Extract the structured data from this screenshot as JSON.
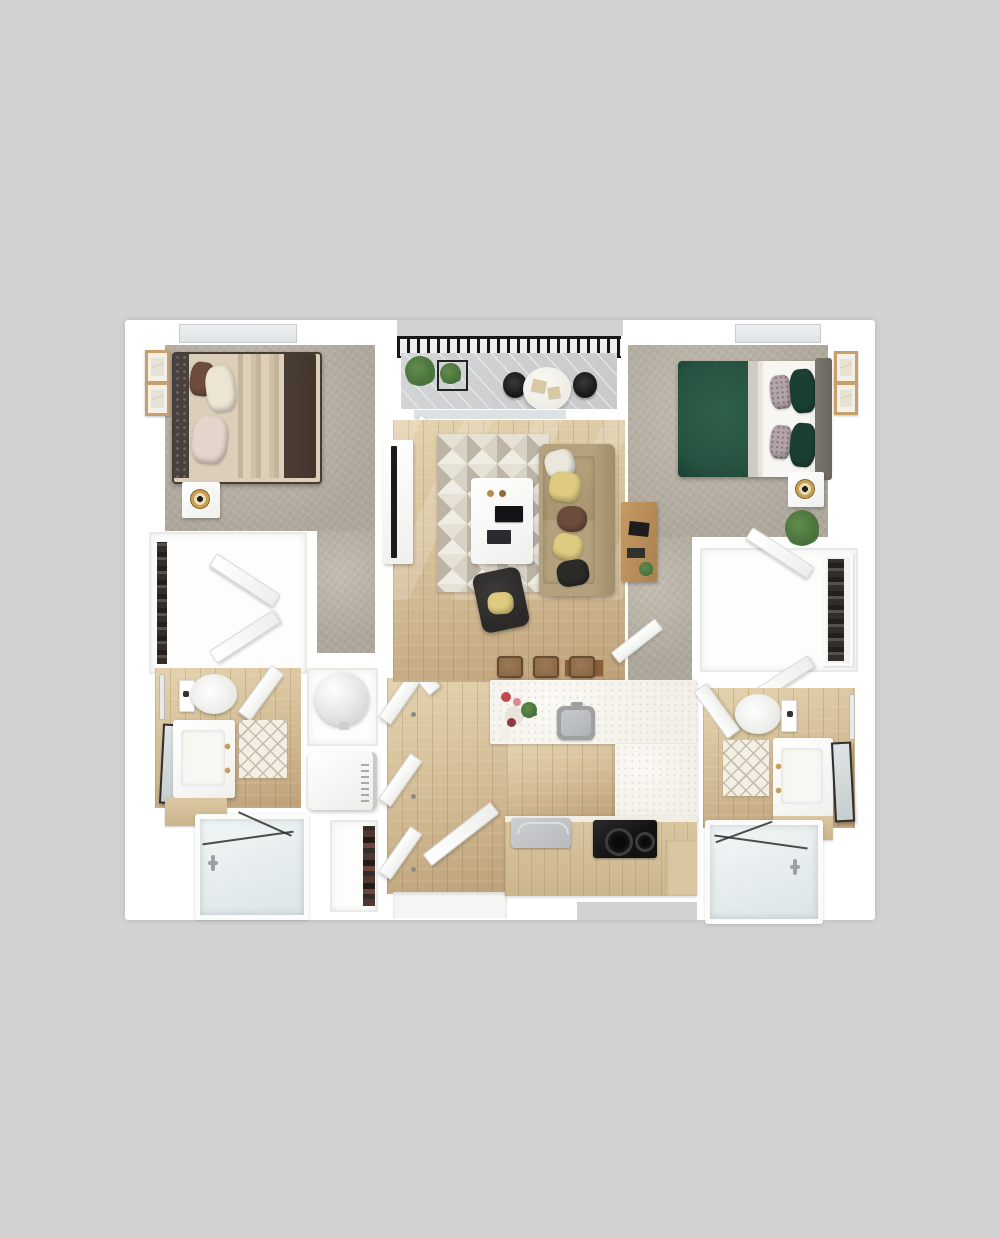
{
  "scene": {
    "label": "Top-down 3D rendered floor plan of a two-bedroom, two-bathroom apartment with balcony",
    "render_style": "photorealistic 3D dollhouse view on plain gray background",
    "text_visible": "none"
  },
  "palette": {
    "bg": "#d2d2d2",
    "wall": "#ffffff",
    "wallsh": "#e9e9e6",
    "carpet": "#aea79b",
    "carpet2": "#c4bdb1",
    "wood": "#d2bb94",
    "wood2": "#bda078",
    "wood3": "#e4d3af",
    "deck": "#c7c9cb",
    "rail": "#161616",
    "glass": "#dce1e4",
    "rugA": "#d8d2c4",
    "rugB": "#efece4",
    "rugC": "#bcb4a4",
    "rugD": "#e6e1d5",
    "sofa": "#b4a17d",
    "sofa2": "#a08d69",
    "pilW": "#ece7dc",
    "pilY": "#decb7f",
    "pilBr": "#6d4c3c",
    "pilBk": "#2c2a27",
    "chairBk": "#2b2a28",
    "white1": "#f6f4ef",
    "bed1hb": "#49423c",
    "bed1duv": "#42352d",
    "pilBlush": "#e4d4cb",
    "pilCream": "#ece5d4",
    "bed2green": "#265341",
    "bed2green2": "#1b4031",
    "duvW": "#f7f6f2",
    "bed2hb": "#6b645e",
    "pilPat": "#b3a4aa",
    "gold": "#c79f52",
    "frame": "#c8a06b",
    "counter": "#f3f0e9",
    "cab": "#cbb58d",
    "cab2": "#dac7a1",
    "cooktop": "#121212",
    "steel": "#b7babc",
    "tub": "#e7edee",
    "tubLine": "#30302e",
    "fix": "#9aa0a3",
    "plant": "#47703b",
    "plant2": "#628c4b",
    "mat": "#8a5f38",
    "shelfItems": "#322e2a",
    "stool": "#8a6847"
  },
  "rooms": {
    "bedroom1": {
      "label": "Bedroom 1 (top left)",
      "flooring": "gray carpet",
      "furniture": [
        "upholstered bed with beige blanket and dark duvet",
        "nightstand with gold lamp",
        "two framed artworks",
        "window",
        "open bedroom door"
      ]
    },
    "closet1": {
      "label": "Bedroom 1 walk-in closet",
      "furniture": [
        "hanging rod with clothes",
        "double doors ajar"
      ]
    },
    "bathroom1": {
      "label": "Bathroom 1 (bottom left)",
      "flooring": "wood plank",
      "furniture": [
        "toilet",
        "towel bar",
        "vanity with sink and gold faucet",
        "leaning mirror",
        "tan counter bench",
        "diamond-pattern rug",
        "glass-enclosed bathtub",
        "open door"
      ]
    },
    "utility": {
      "label": "Utility closets (center left)",
      "furniture": [
        "water heater",
        "washer-dryer",
        "pantry shelving"
      ]
    },
    "hall": {
      "label": "Entry hallway",
      "flooring": "wood plank",
      "furniture": [
        "three open interior doors",
        "open entry door",
        "entry threshold"
      ]
    },
    "living": {
      "label": "Living room (center)",
      "flooring": "wood plank",
      "furniture": [
        "tan sofa with five throw pillows",
        "geometric triangle rug",
        "white coffee table with books and cups",
        "black accent chair with yellow pillow",
        "media console with TV",
        "brown doormat"
      ]
    },
    "balcony": {
      "label": "Balcony (top center)",
      "furniture": [
        "black metal railing",
        "plank decking",
        "two potted plants",
        "round bistro table",
        "two black chairs",
        "sliding glass door ajar"
      ]
    },
    "kitchen": {
      "label": "Kitchen (bottom center)",
      "furniture": [
        "white quartz island with stainless sink",
        "three bar stools",
        "flower and plate decor",
        "peninsula counter",
        "wood-front lower cabinets",
        "stainless dishwasher",
        "black glass cooktop"
      ]
    },
    "bedroom2": {
      "label": "Bedroom 2 (top right)",
      "flooring": "gray carpet",
      "furniture": [
        "bed with green comforter and white duvet",
        "gray headboard",
        "nightstand with gold lamp",
        "two framed artworks",
        "potted plant",
        "wood desk with laptop",
        "window",
        "open bedroom door"
      ]
    },
    "closet2": {
      "label": "Bedroom 2 walk-in closet",
      "furniture": [
        "shelf unit with clothes",
        "double doors ajar"
      ]
    },
    "bathroom2": {
      "label": "Bathroom 2 (bottom right)",
      "flooring": "wood plank",
      "furniture": [
        "toilet",
        "towel bar",
        "vanity with sink and gold faucet",
        "leaning mirror",
        "diamond-pattern rug",
        "glass-enclosed bathtub",
        "open door"
      ]
    }
  }
}
